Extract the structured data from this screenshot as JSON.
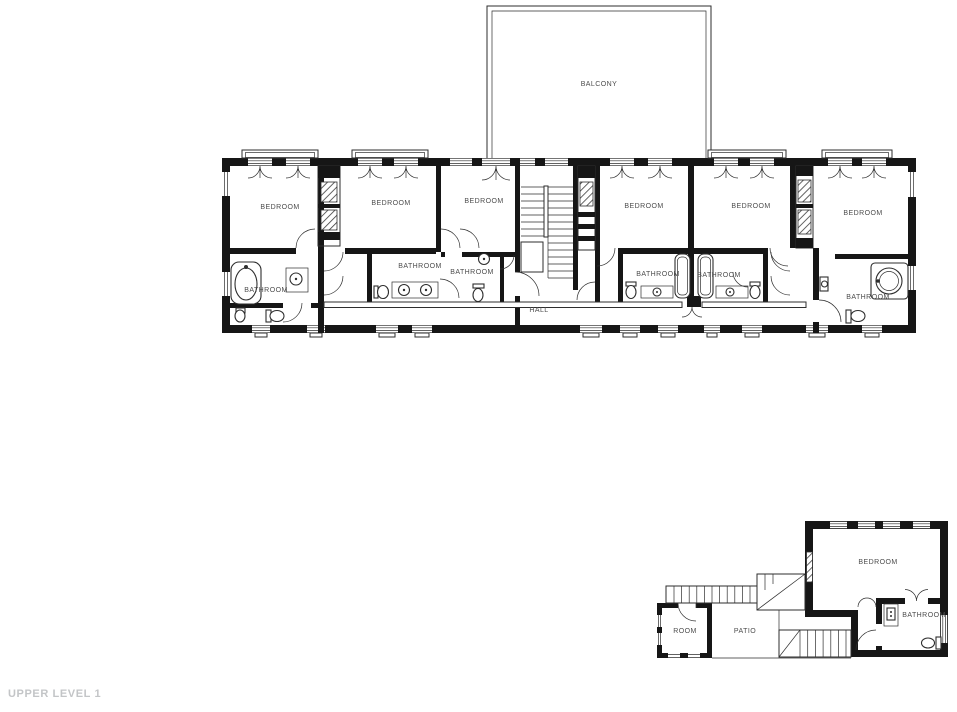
{
  "page": {
    "title": "UPPER LEVEL 1"
  },
  "colors": {
    "background": "#ffffff",
    "wall": "#161616",
    "line": "#2e2e2e",
    "label": "#4d4d4d",
    "title": "#c3c5c7"
  },
  "plan": {
    "level_name": "UPPER LEVEL 1",
    "rooms": [
      {
        "id": "balcony",
        "label": "BALCONY",
        "x": 599,
        "y": 86
      },
      {
        "id": "bedroom-1",
        "label": "BEDROOM",
        "x": 280,
        "y": 209
      },
      {
        "id": "bedroom-2",
        "label": "BEDROOM",
        "x": 391,
        "y": 205
      },
      {
        "id": "bedroom-3",
        "label": "BEDROOM",
        "x": 484,
        "y": 203
      },
      {
        "id": "bedroom-4",
        "label": "BEDROOM",
        "x": 644,
        "y": 208
      },
      {
        "id": "bedroom-5",
        "label": "BEDROOM",
        "x": 751,
        "y": 208
      },
      {
        "id": "bedroom-6",
        "label": "BEDROOM",
        "x": 863,
        "y": 215
      },
      {
        "id": "bathroom-1",
        "label": "BATHROOM",
        "x": 266,
        "y": 292
      },
      {
        "id": "bathroom-2",
        "label": "BATHROOM",
        "x": 420,
        "y": 268
      },
      {
        "id": "bathroom-3",
        "label": "BATHROOM",
        "x": 472,
        "y": 274
      },
      {
        "id": "bathroom-4",
        "label": "BATHROOM",
        "x": 658,
        "y": 276
      },
      {
        "id": "bathroom-5",
        "label": "BATHROOM",
        "x": 719,
        "y": 277
      },
      {
        "id": "bathroom-6",
        "label": "BATHROOM",
        "x": 868,
        "y": 299
      },
      {
        "id": "hall",
        "label": "HALL",
        "x": 539,
        "y": 312
      },
      {
        "id": "guest-bedroom",
        "label": "BEDROOM",
        "x": 878,
        "y": 564
      },
      {
        "id": "guest-bathroom",
        "label": "BATHROOM",
        "x": 924,
        "y": 617
      },
      {
        "id": "room",
        "label": "ROOM",
        "x": 685,
        "y": 633
      },
      {
        "id": "patio",
        "label": "PATIO",
        "x": 745,
        "y": 633
      }
    ]
  }
}
